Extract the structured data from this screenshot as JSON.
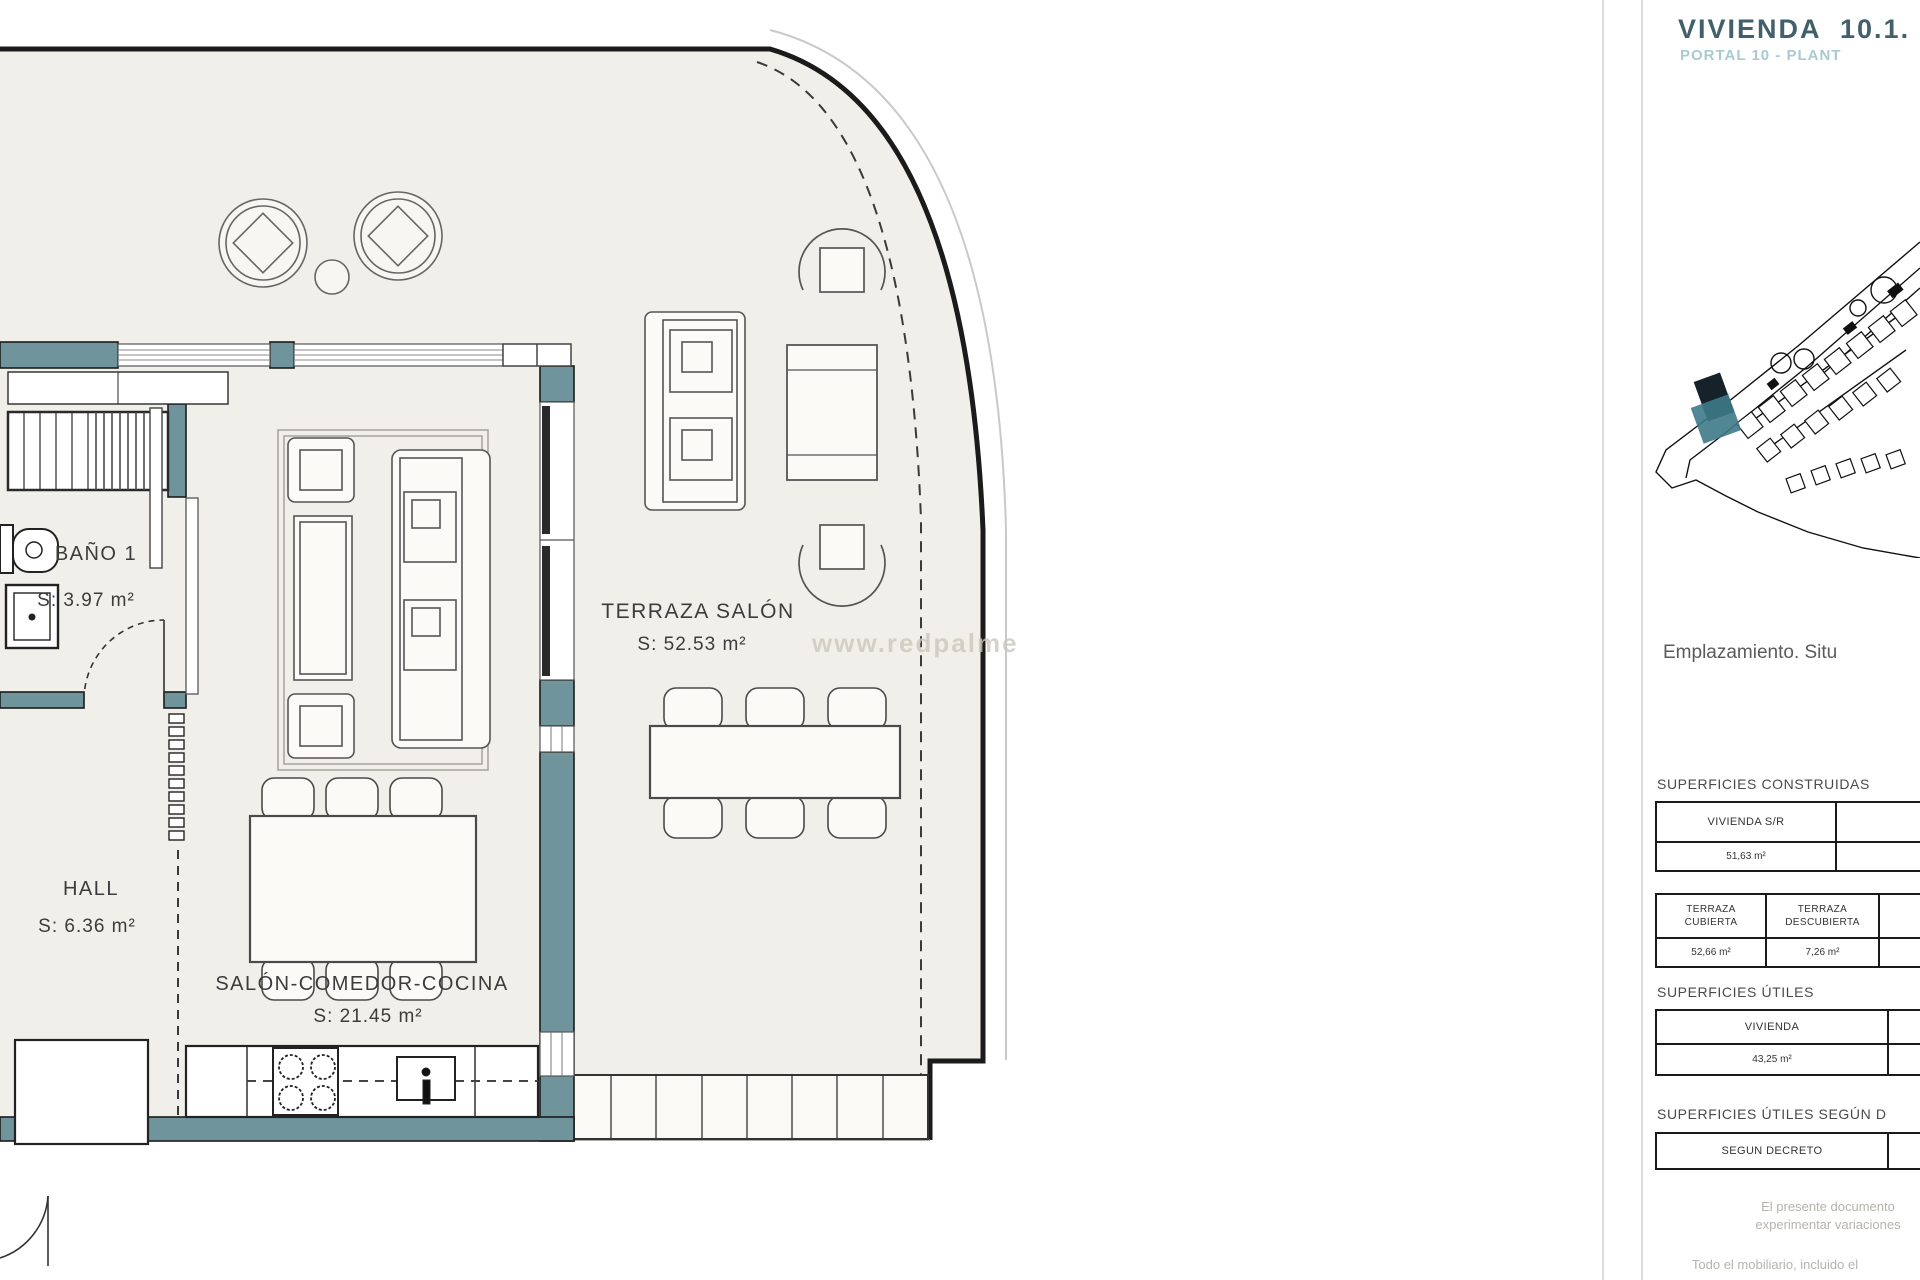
{
  "panel": {
    "title": "VIVIENDA  10.1.",
    "subtitle": "PORTAL 10 - PLANT",
    "emplazamiento": "Emplazamiento. Situ",
    "sections": {
      "construidas_label": "SUPERFICIES CONSTRUIDAS",
      "utiles_label": "SUPERFICIES ÚTILES",
      "utiles_decreto_label": "SUPERFICIES ÚTILES SEGÚN D"
    },
    "tables": {
      "construidas1": {
        "headers": [
          "VIVIENDA S/R"
        ],
        "values": [
          "51,63 m²"
        ]
      },
      "construidas2": {
        "headers": [
          "TERRAZA\nCUBIERTA",
          "TERRAZA\nDESCUBIERTA"
        ],
        "values": [
          "52,66 m²",
          "7,26 m²"
        ]
      },
      "utiles": {
        "headers": [
          "VIVIENDA"
        ],
        "values": [
          "43,25 m²"
        ]
      },
      "decreto": {
        "headers": [
          "SEGUN DECRETO"
        ]
      }
    },
    "notes": [
      "El presente documento",
      "experimentar variaciones",
      "Todo el mobiliario, incluido el"
    ]
  },
  "plan": {
    "rooms": [
      {
        "name": "BAÑO 1",
        "area": "S: 3.97  m²"
      },
      {
        "name": "HALL",
        "area": "S: 6.36  m²"
      },
      {
        "name": "SALÓN-COMEDOR-COCINA",
        "area": "S: 21.45 m²"
      },
      {
        "name": "TERRAZA SALÓN",
        "area": "S: 52.53 m²"
      }
    ],
    "watermark": "www.redpalme",
    "colors": {
      "wall_teal": "#6f949c",
      "floor_beige": "#f1efe9",
      "title": "#42606c",
      "subtitle": "#a9cbd0",
      "site_unit_highlight": "#3e7a88"
    }
  }
}
